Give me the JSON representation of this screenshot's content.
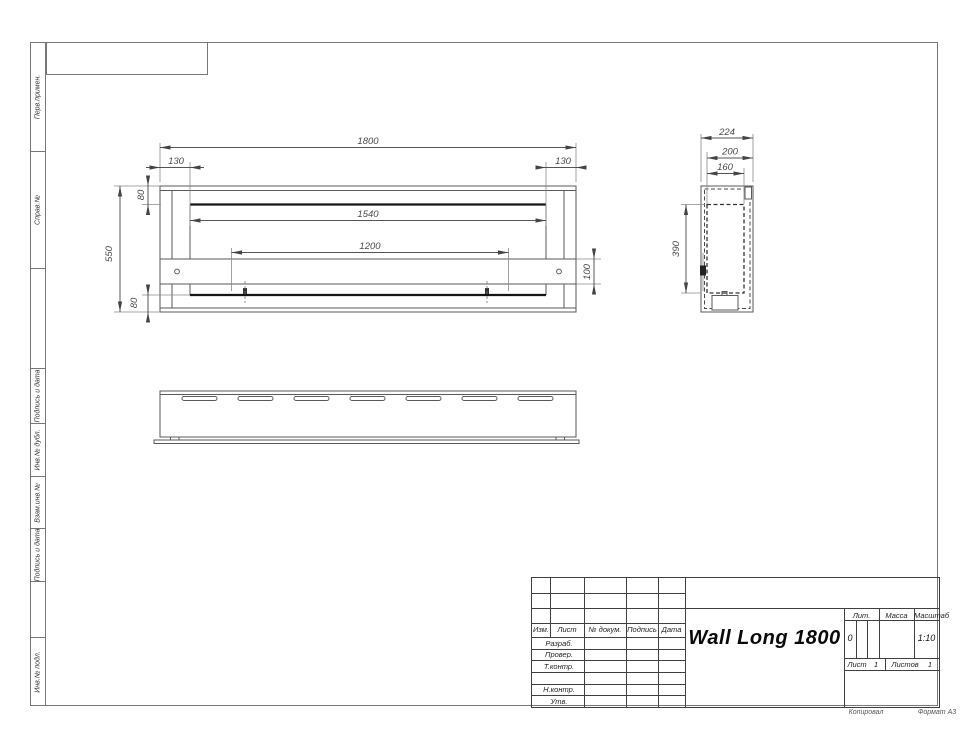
{
  "drawing": {
    "front": {
      "dim_total_width": "1800",
      "dim_left_offset": "130",
      "dim_right_offset": "130",
      "dim_top_band": "80",
      "dim_opening_width": "1540",
      "dim_bar_span": "1200",
      "dim_total_height": "550",
      "dim_bar_height": "100",
      "dim_bottom_band": "80"
    },
    "side": {
      "dim_depth": "224",
      "dim_inner_depth": "200",
      "dim_opening_depth": "160",
      "dim_opening_height": "390"
    }
  },
  "sidebar": {
    "cells": [
      {
        "label": "Перв.примен."
      },
      {
        "label": "Справ.№"
      },
      {
        "label": ""
      },
      {
        "label": "Подпись и дата"
      },
      {
        "label": "Инв.№ дубл."
      },
      {
        "label": "Взам.инв.№"
      },
      {
        "label": "Подпись и дата"
      },
      {
        "label": ""
      },
      {
        "label": "Инв.№ подл."
      }
    ]
  },
  "title_block": {
    "doc_name": "Wall Long 1800",
    "header_cols": [
      "Изм.",
      "Лист",
      "№ докум.",
      "Подпись",
      "Дата"
    ],
    "row_labels": [
      "Разраб.",
      "Провер.",
      "Т.контр.",
      "",
      "Н.контр.",
      "Утв."
    ],
    "lit_label": "Лит.",
    "lit_value": "0",
    "mass_label": "Масса",
    "scale_label": "Масштаб",
    "scale_value": "1:10",
    "sheet_label": "Лист",
    "sheet_value": "1",
    "sheets_label": "Листов",
    "sheets_value": "1"
  },
  "footer": {
    "copy_label": "Копировал",
    "format_label": "Формат А3"
  }
}
